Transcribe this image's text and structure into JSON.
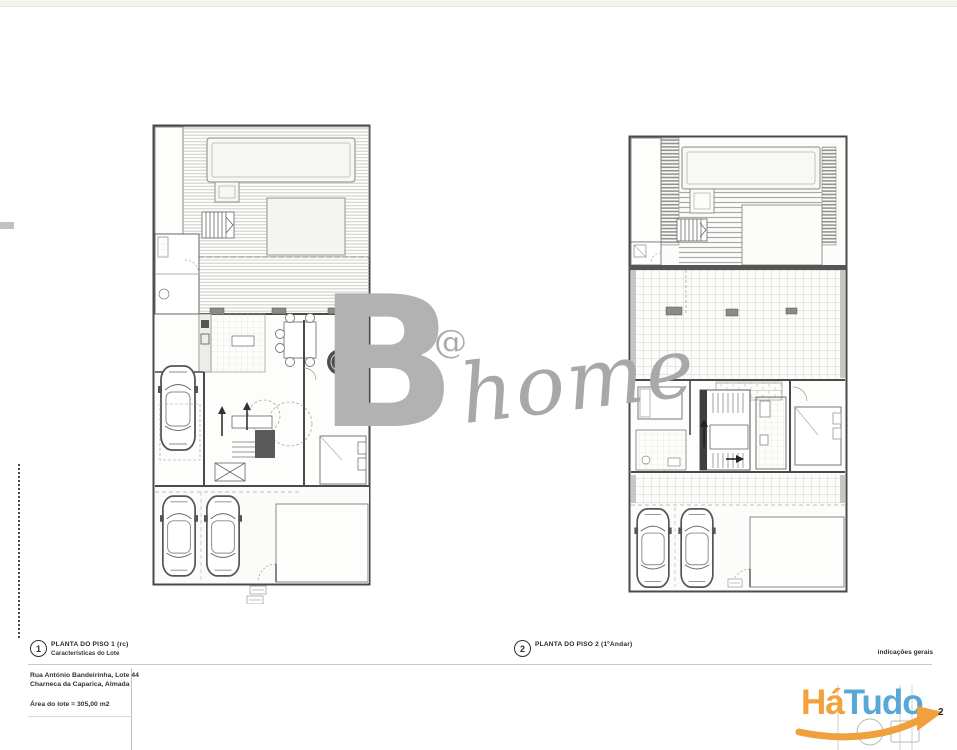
{
  "page": {
    "top_band_color": "#f4f4ef",
    "background": "#ffffff"
  },
  "watermark": {
    "letter": "B",
    "at_sign": "@",
    "script_word": "home",
    "color": "#b0b0b0"
  },
  "plans": [
    {
      "number": "1",
      "title": "PLANTA DO PISO 1 (rc)",
      "subtitle": "Características do Lote"
    },
    {
      "number": "2",
      "title": "PLANTA DO PISO 2 (1ºAndar)",
      "subtitle": ""
    }
  ],
  "title_block": {
    "address_line1": "Rua António Bandeirinha, Lote 44",
    "address_line2": "Charneca da Caparica, Almada",
    "area_line": "Área do lote = 305,00 m2",
    "general_notes_label": "indicações gerais",
    "sheet_number": "2"
  },
  "brand_logo": {
    "part1": "Há",
    "part2": "Tudo",
    "orange": "#F2A13B",
    "blue": "#59A7D6",
    "swoosh_icon": "orange-arrow-swoosh"
  }
}
